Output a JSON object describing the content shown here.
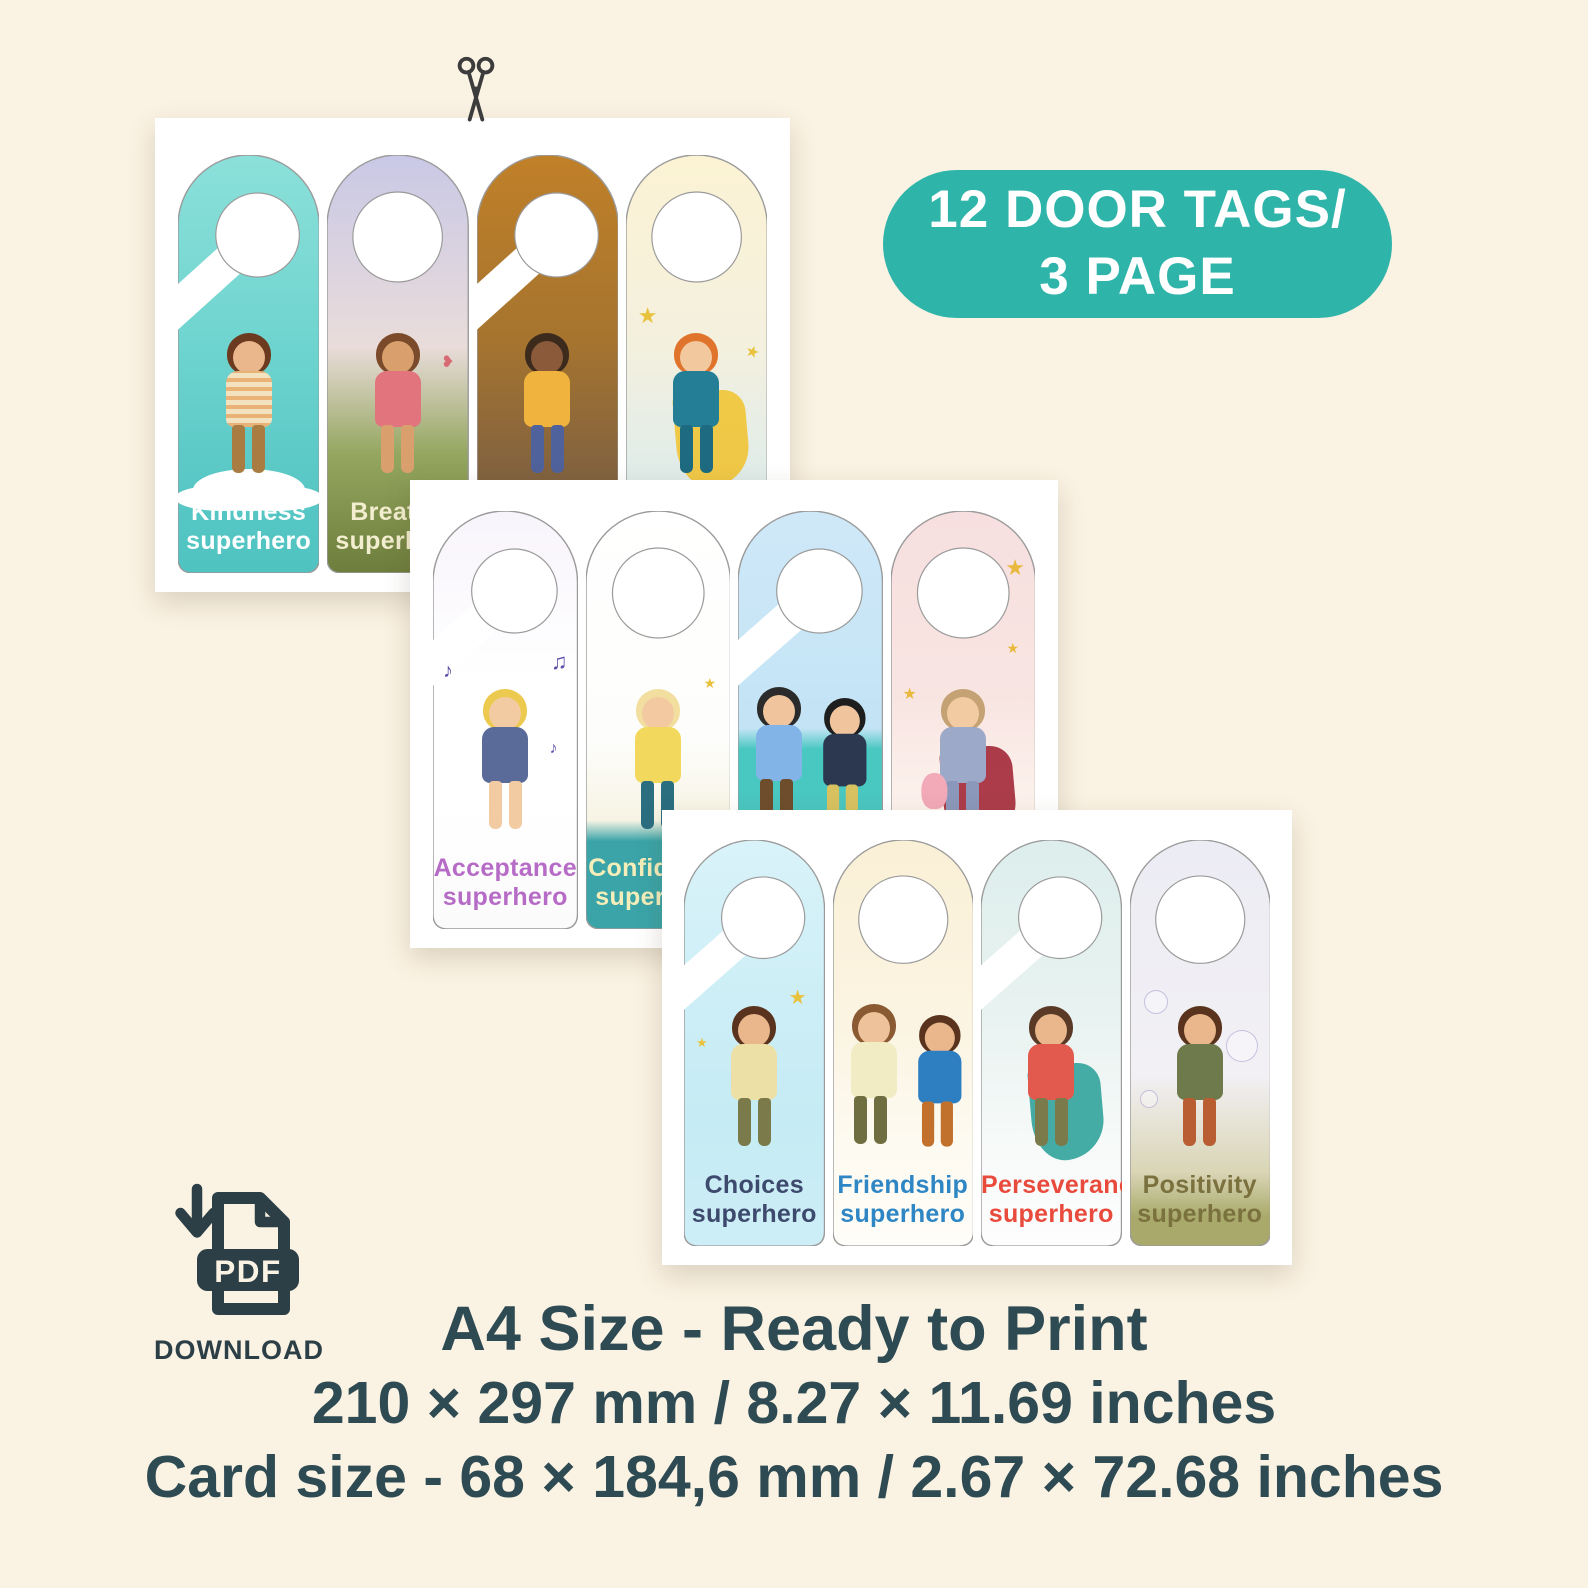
{
  "badge": {
    "line1": "12 DOOR TAGS/",
    "line2": "3 PAGE",
    "bg_color": "#2fb4aa",
    "text_color": "#ffffff"
  },
  "icons": {
    "scissors": "scissors-icon",
    "pdf_download": "pdf-download-icon"
  },
  "download": {
    "pdf_label": "PDF",
    "label": "DOWNLOAD",
    "color": "#2d3f46"
  },
  "footer": {
    "line1": "A4 Size - Ready to Print",
    "line2": "210 × 297 mm / 8.27 × 11.69 inches",
    "line3": "Card size - 68 × 184,6 mm / 2.67 × 72.68 inches",
    "color": "#2e4a52"
  },
  "pages": [
    {
      "name": "page-1",
      "tags": [
        {
          "hanger": "hook",
          "illustration": "boy-standing-on-cloud",
          "label_line1": "Kindness",
          "label_line2": "superhero",
          "label_color": "#ffffff",
          "bg": [
            "#8ce0da",
            "#6fd4cf",
            "#5bc9c6",
            "#4fc3c1"
          ],
          "character": {
            "hair": "#6b3a1f",
            "skin": "#eab78c",
            "shirt": "#f3e2c0",
            "pants": "#a97c42"
          }
        },
        {
          "hanger": "ring",
          "illustration": "girl-meditating",
          "label_line1": "Breathe",
          "label_line2": "superhero",
          "label_color": "#f2eecf",
          "bg": [
            "#c9c8e6",
            "#e9dcda",
            "#93a65e",
            "#6d7d3c"
          ],
          "character": {
            "hair": "#7a4a2a",
            "skin": "#d9a06e",
            "shirt": "#e2747e",
            "pants": "#d9a06e"
          }
        },
        {
          "hanger": "hook",
          "illustration": "girl-under-autumn-tree",
          "label_line1": "",
          "label_line2": "",
          "label_color": "#ffffff",
          "bg": [
            "#c08028",
            "#a5742f",
            "#7b5f42",
            "#7e9b55"
          ],
          "character": {
            "hair": "#3c2a1d",
            "skin": "#8a5a3b",
            "shirt": "#f0b43e",
            "pants": "#50629c"
          }
        },
        {
          "hanger": "ring",
          "illustration": "boy-with-yellow-cape-holding-orb",
          "label_line1": "",
          "label_line2": "",
          "label_color": "#ffffff",
          "bg": [
            "#fcf3d4",
            "#f4f0de",
            "#d9ebee",
            "#7a598a"
          ],
          "cape": "#f0c63e",
          "sparkle_color": "#e8c23c",
          "character": {
            "hair": "#e0742c",
            "skin": "#f2c89e",
            "shirt": "#247f96",
            "pants": "#1e6a80"
          }
        }
      ]
    },
    {
      "name": "page-2",
      "tags": [
        {
          "hanger": "hook",
          "illustration": "girl-singing-with-microphone",
          "label_line1": "Acceptance",
          "label_line2": "superhero",
          "label_color": "#b66cc6",
          "bg": [
            "#f8f4fb",
            "#ffffff",
            "#ffffff",
            "#fbfbfb"
          ],
          "notes_color": "#5a4fa8",
          "character": {
            "hair": "#ecc94f",
            "skin": "#f2cba2",
            "shirt": "#5a6a99",
            "pants": "#f2cba2"
          }
        },
        {
          "hanger": "ring",
          "illustration": "boy-with-fist-raised",
          "label_line1": "Confidence",
          "label_line2": "superhero",
          "label_color": "#f5eeba",
          "bg": [
            "#ffffff",
            "#fdfdfb",
            "#f7f4e4",
            "#3aa4a8"
          ],
          "character": {
            "hair": "#f2dfa0",
            "skin": "#f2c9a0",
            "shirt": "#f2d85c",
            "pants": "#2a6e80"
          }
        },
        {
          "hanger": "hook",
          "illustration": "two-boys-holding-hands-on-beach",
          "label_line1": "",
          "label_line2": "",
          "label_color": "#ffffff",
          "bg": [
            "#cfe8f8",
            "#c3e4f5",
            "#49c7c1",
            "#efe2c0"
          ],
          "character": {
            "hair": "#2b2b2b",
            "skin": "#f0c49c",
            "shirt": "#82b4e8",
            "pants": "#6e4d2c"
          },
          "character2": {
            "hair": "#1e1e1e",
            "skin": "#f0c49c",
            "shirt": "#2b3850",
            "pants": "#d8c260"
          }
        },
        {
          "hanger": "ring",
          "illustration": "grandma-superhero-holding-baby",
          "label_line1": "",
          "label_line2": "",
          "label_color": "#ffffff",
          "bg": [
            "#f7dfdf",
            "#f8e5e2",
            "#fdf4ee",
            "#ffffff"
          ],
          "cape": "#a83240",
          "baby": "#f2a9b8",
          "sparkle_color": "#e8b93c",
          "character": {
            "hair": "#c4a273",
            "skin": "#f2cba2",
            "shirt": "#9ca9c9",
            "pants": "#8b98bb"
          }
        }
      ]
    },
    {
      "name": "page-3",
      "tags": [
        {
          "hanger": "hook",
          "illustration": "boy-with-hands-on-chest",
          "label_line1": "Choices",
          "label_line2": "superhero",
          "label_color": "#3d4a6e",
          "bg": [
            "#d9f3f9",
            "#cdeef6",
            "#c5ebf4",
            "#cdeef6"
          ],
          "sparkle_color": "#e8c23c",
          "character": {
            "hair": "#59331d",
            "skin": "#eab78c",
            "shirt": "#ece0a6",
            "pants": "#7b7a4a"
          }
        },
        {
          "hanger": "ring",
          "illustration": "two-boys-high-five",
          "label_line1": "Friendship",
          "label_line2": "superhero",
          "label_color": "#2e86c4",
          "bg": [
            "#faf0d6",
            "#fbf4e2",
            "#fdfaf1",
            "#fffdf8"
          ],
          "character": {
            "hair": "#8a5a33",
            "skin": "#eec29a",
            "shirt": "#f2ecc4",
            "pants": "#6e6e40"
          },
          "character2": {
            "hair": "#59331d",
            "skin": "#eab78c",
            "shirt": "#2e7fc2",
            "pants": "#c2712c"
          }
        },
        {
          "hanger": "hook",
          "illustration": "boy-with-teal-cape",
          "label_line1": "Perseverance",
          "label_line2": "superhero",
          "label_color": "#e84a3c",
          "bg": [
            "#ddeeec",
            "#e9f3f1",
            "#f7faf9",
            "#fdfdfd"
          ],
          "cape": "#3aa8a0",
          "character": {
            "hair": "#5a3a26",
            "skin": "#eab78c",
            "shirt": "#e25a4e",
            "pants": "#7b7a4a"
          }
        },
        {
          "hanger": "ring",
          "illustration": "boy-jumping-with-bubbles",
          "label_line1": "Positivity",
          "label_line2": "superhero",
          "label_color": "#7a713e",
          "bg": [
            "#ececf4",
            "#f2f0f4",
            "#d9d5b5",
            "#a8a96a"
          ],
          "character": {
            "hair": "#59331d",
            "skin": "#eab78c",
            "shirt": "#6e7a4c",
            "pants": "#b85e32"
          }
        }
      ]
    }
  ]
}
